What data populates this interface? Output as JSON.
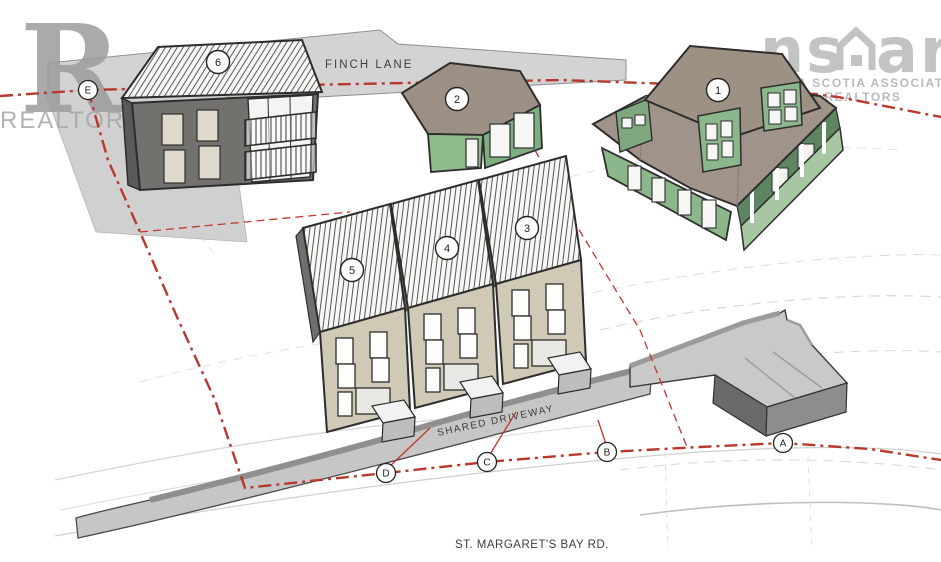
{
  "title": "Site plan rendering - proposed development",
  "roads": {
    "finch_lane": "FINCH LANE",
    "shared_driveway": "SHARED DRIVEWAY",
    "st_margarets_bay_rd": "ST. MARGARET'S BAY RD."
  },
  "watermarks": {
    "realtor_logo_letter": "R",
    "realtor_logo_registered": "®",
    "realtor_text": "REALTOR®",
    "nsar_left": "ns",
    "nsar_right": "ar",
    "nsar_line1": "NOVA SCOTIA ASSOCIATION",
    "nsar_line2": "OF REALTORS"
  },
  "buildings": [
    {
      "label": "1"
    },
    {
      "label": "2"
    },
    {
      "label": "3"
    },
    {
      "label": "4"
    },
    {
      "label": "5"
    },
    {
      "label": "6"
    }
  ],
  "boundary_markers": [
    {
      "label": "E"
    },
    {
      "label": "D"
    },
    {
      "label": "C"
    },
    {
      "label": "B"
    },
    {
      "label": "A"
    }
  ],
  "palette": {
    "boundary_red": "#b8392c",
    "house_green": "#8fbc8c",
    "roof_taupe": "#9c9084",
    "townhouse_beige": "#cfc9b5",
    "road_gray": "#d3d3d3",
    "pad_gray": "#c9c9c9",
    "contour_gray": "#d2d2d2"
  }
}
